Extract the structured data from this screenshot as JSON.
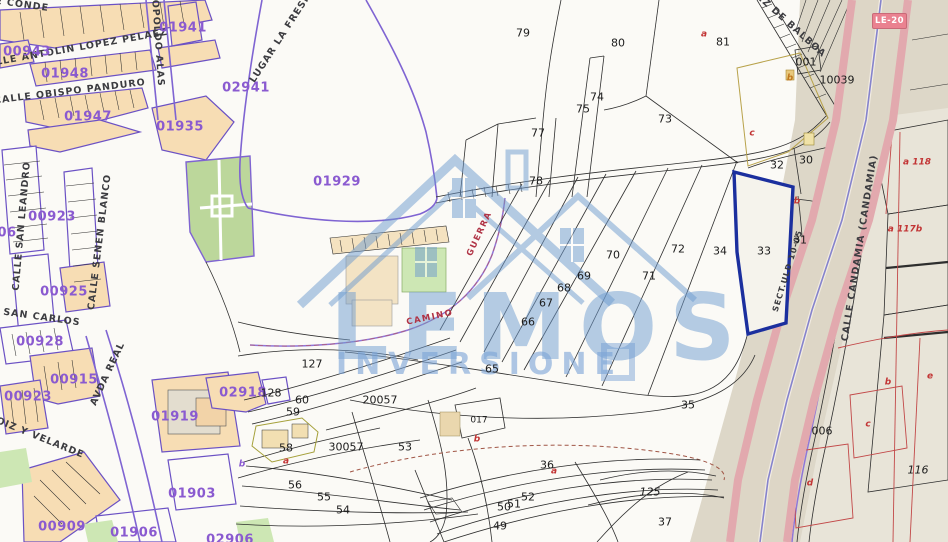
{
  "app": {
    "type": "cadastral-parcel-map"
  },
  "watermark": {
    "brand_top": "LEMOS",
    "brand_bottom": "INVERSIONE",
    "color": "#6e9bcf"
  },
  "road_badge": {
    "label": "LE-20",
    "bg": "#ea8290",
    "fg": "#ffffff"
  },
  "highlighted_parcel": {
    "number": "33",
    "outline_color": "#1b2f9e"
  },
  "colors": {
    "block_fill": "#f7ddb4",
    "block_boundary_purple": "#7f64d2",
    "code_purple": "#8a5ad0",
    "park_green": "#bcd79b",
    "highway_pink": "#e2a9ae",
    "corridor_beige": "#ddd7c8",
    "parcel_line_black": "#2e2e2e",
    "sub_letter_red": "#c23535"
  },
  "label_groups": [
    {
      "name": "street-name",
      "color": "#3c3c40",
      "size": 9.5,
      "weight": "bold",
      "ls": 1,
      "items": [
        {
          "t": "E CONDE",
          "x": 22,
          "y": 5,
          "r": 8
        },
        {
          "t": "CALLE ANTOLIN LOPEZ PELAEZ",
          "x": 74,
          "y": 49,
          "r": -10
        },
        {
          "t": "CALLE OBISPO PANDURO",
          "x": 70,
          "y": 92,
          "r": -7
        },
        {
          "t": "LEOPOLDO ALAS",
          "x": 157,
          "y": 36,
          "r": 86
        },
        {
          "t": "LUGAR LA FRESN",
          "x": 281,
          "y": 38,
          "r": -57
        },
        {
          "t": "CALLE SAN LEANDRO",
          "x": 22,
          "y": 226,
          "r": -85
        },
        {
          "t": "CALLE SENEN BLANCO",
          "x": 100,
          "y": 242,
          "r": -83
        },
        {
          "t": "E SAN CARLOS",
          "x": 36,
          "y": 317,
          "r": 8
        },
        {
          "t": "AVDA REAL",
          "x": 108,
          "y": 374,
          "r": -65
        },
        {
          "t": "DAOIZ Y VELARDE",
          "x": 32,
          "y": 435,
          "r": 22
        },
        {
          "t": "EZ DE BALBOA",
          "x": 791,
          "y": 26,
          "r": 42
        },
        {
          "t": "CALLE CANDAMIA (CANDAMIA)",
          "x": 860,
          "y": 248,
          "r": -81
        },
        {
          "t": "SECT.ULD 10-05",
          "x": 788,
          "y": 271,
          "r": -73,
          "s": 8
        }
      ]
    },
    {
      "name": "block-code",
      "color": "#8a5ad0",
      "size": 13,
      "weight": "bold",
      "ls": 0.5,
      "items": [
        {
          "t": "00943",
          "x": 27,
          "y": 52
        },
        {
          "t": "01948",
          "x": 65,
          "y": 74
        },
        {
          "t": "01947",
          "x": 88,
          "y": 117
        },
        {
          "t": "01935",
          "x": 180,
          "y": 127
        },
        {
          "t": "01941",
          "x": 183,
          "y": 28
        },
        {
          "t": "02941",
          "x": 246,
          "y": 88
        },
        {
          "t": "01929",
          "x": 337,
          "y": 182
        },
        {
          "t": "00923",
          "x": 52,
          "y": 217
        },
        {
          "t": "00925",
          "x": 64,
          "y": 292
        },
        {
          "t": "00928",
          "x": 40,
          "y": 342
        },
        {
          "t": "00915",
          "x": 74,
          "y": 380
        },
        {
          "t": "00923",
          "x": 28,
          "y": 397
        },
        {
          "t": "01919",
          "x": 175,
          "y": 417
        },
        {
          "t": "02918",
          "x": 243,
          "y": 393
        },
        {
          "t": "00909",
          "x": 62,
          "y": 527
        },
        {
          "t": "01903",
          "x": 192,
          "y": 494
        },
        {
          "t": "01906",
          "x": 134,
          "y": 533
        },
        {
          "t": "02906",
          "x": 230,
          "y": 540
        },
        {
          "t": "06",
          "x": 7,
          "y": 233
        }
      ]
    },
    {
      "name": "parcel-number",
      "color": "#1c1c1c",
      "size": 11,
      "weight": "normal",
      "ls": 0,
      "items": [
        {
          "t": "79",
          "x": 523,
          "y": 33
        },
        {
          "t": "80",
          "x": 618,
          "y": 43
        },
        {
          "t": "81",
          "x": 723,
          "y": 42
        },
        {
          "t": "74",
          "x": 597,
          "y": 97
        },
        {
          "t": "75",
          "x": 583,
          "y": 109
        },
        {
          "t": "73",
          "x": 665,
          "y": 119
        },
        {
          "t": "77",
          "x": 538,
          "y": 133
        },
        {
          "t": "78",
          "x": 536,
          "y": 181
        },
        {
          "t": "70",
          "x": 613,
          "y": 255
        },
        {
          "t": "72",
          "x": 678,
          "y": 249
        },
        {
          "t": "34",
          "x": 720,
          "y": 251
        },
        {
          "t": "69",
          "x": 584,
          "y": 276
        },
        {
          "t": "71",
          "x": 649,
          "y": 276
        },
        {
          "t": "68",
          "x": 564,
          "y": 288
        },
        {
          "t": "67",
          "x": 546,
          "y": 303
        },
        {
          "t": "66",
          "x": 528,
          "y": 322
        },
        {
          "t": "65",
          "x": 492,
          "y": 369
        },
        {
          "t": "32",
          "x": 777,
          "y": 165
        },
        {
          "t": "30",
          "x": 806,
          "y": 160
        },
        {
          "t": "31",
          "x": 800,
          "y": 240
        },
        {
          "t": "33",
          "x": 764,
          "y": 251
        },
        {
          "t": "35",
          "x": 688,
          "y": 405
        },
        {
          "t": "36",
          "x": 547,
          "y": 465
        },
        {
          "t": "37",
          "x": 665,
          "y": 522
        },
        {
          "t": "49",
          "x": 500,
          "y": 526
        },
        {
          "t": "50",
          "x": 504,
          "y": 507
        },
        {
          "t": "51",
          "x": 514,
          "y": 504
        },
        {
          "t": "52",
          "x": 528,
          "y": 497
        },
        {
          "t": "53",
          "x": 405,
          "y": 447
        },
        {
          "t": "54",
          "x": 343,
          "y": 510
        },
        {
          "t": "55",
          "x": 324,
          "y": 497
        },
        {
          "t": "56",
          "x": 295,
          "y": 485
        },
        {
          "t": "58",
          "x": 286,
          "y": 448
        },
        {
          "t": "59",
          "x": 293,
          "y": 412
        },
        {
          "t": "60",
          "x": 302,
          "y": 400
        },
        {
          "t": "127",
          "x": 312,
          "y": 364
        },
        {
          "t": "128",
          "x": 271,
          "y": 393
        },
        {
          "t": "001",
          "x": 806,
          "y": 62
        },
        {
          "t": "10039",
          "x": 837,
          "y": 80
        },
        {
          "t": "017",
          "x": 479,
          "y": 421,
          "s": 9
        },
        {
          "t": "006",
          "x": 822,
          "y": 431
        },
        {
          "t": "20057",
          "x": 380,
          "y": 400
        },
        {
          "t": "30057",
          "x": 346,
          "y": 447
        },
        {
          "t": "125",
          "x": 650,
          "y": 492,
          "i": true
        },
        {
          "t": "116",
          "x": 918,
          "y": 470,
          "i": true
        }
      ]
    },
    {
      "name": "sub-letter",
      "color": "#c23535",
      "size": 9,
      "weight": "bold",
      "ls": 0,
      "italic": true,
      "items": [
        {
          "t": "a",
          "x": 704,
          "y": 35
        },
        {
          "t": "c",
          "x": 752,
          "y": 134
        },
        {
          "t": "b",
          "x": 797,
          "y": 202
        },
        {
          "t": "a 118",
          "x": 917,
          "y": 163
        },
        {
          "t": "a 117b",
          "x": 905,
          "y": 230
        },
        {
          "t": "b",
          "x": 888,
          "y": 383
        },
        {
          "t": "c",
          "x": 868,
          "y": 425
        },
        {
          "t": "d",
          "x": 810,
          "y": 484
        },
        {
          "t": "e",
          "x": 930,
          "y": 377
        },
        {
          "t": "b",
          "x": 477,
          "y": 440
        },
        {
          "t": "a",
          "x": 554,
          "y": 472
        },
        {
          "t": "a",
          "x": 286,
          "y": 462
        },
        {
          "t": "b",
          "x": 790,
          "y": 79,
          "c": "#c07820"
        },
        {
          "t": "b",
          "x": 242,
          "y": 465,
          "c": "#8a5ad0"
        }
      ]
    },
    {
      "name": "path-label",
      "color": "#b03345",
      "size": 8.5,
      "weight": "bold",
      "ls": 1.5,
      "items": [
        {
          "t": "CAMINO",
          "x": 430,
          "y": 318,
          "r": -12
        },
        {
          "t": "GUERRA",
          "x": 480,
          "y": 234,
          "r": -65
        }
      ]
    }
  ]
}
